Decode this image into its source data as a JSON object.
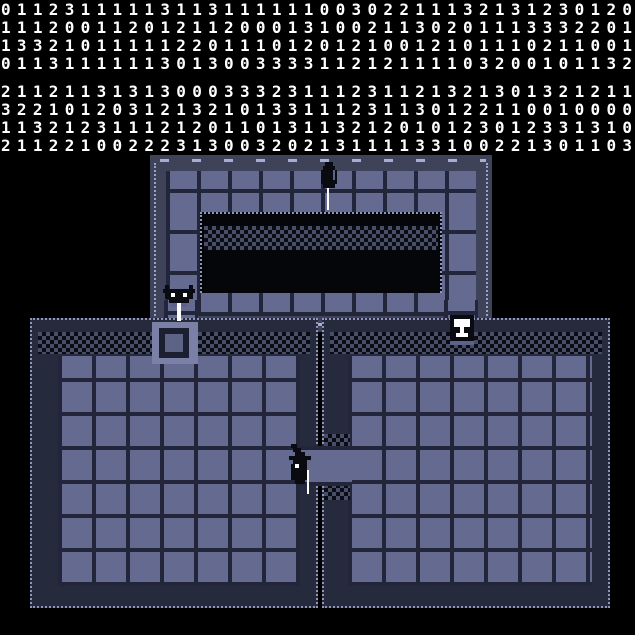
{
  "readout": {
    "description": "tile-code matrix, digits 0-3, two blocks of four rows",
    "digit_color": "#ffffff",
    "rows": [
      "0112311111311311111100302211132131230120",
      "1112001120121120001310021130201113332201",
      "1332101111122011101201210012101110211001",
      "0113111111301300333311212111103200101132",
      "2112113131300033323111231121321301321211",
      "3221012031213210133111231130122110010000",
      "1132123111212011013113212010123012331310",
      "2112210022231300320213111133100221301103"
    ]
  },
  "map": {
    "structure": {
      "top_loop": "ring corridor with dark inner chamber",
      "rooms": "two large tiled rooms joined by a gap passage",
      "links": "two one-tile corridors join the loop to the rooms"
    },
    "entities": [
      {
        "id": "hooded-figure",
        "label": "hooded figure with white staff, top corridor"
      },
      {
        "id": "bat-statue",
        "label": "bat statue over white sword, left junction"
      },
      {
        "id": "goblet-statue",
        "label": "white goblet idol, right junction"
      },
      {
        "id": "witch-figure",
        "label": "witch figure with white staff, center passage"
      },
      {
        "id": "pedestal-tile",
        "label": "square pedestal hatch tile"
      }
    ],
    "palette": {
      "background": "#000000",
      "floor_tile": "#656b90",
      "floor_gap": "#23263a",
      "wall_band": "#3e4359",
      "wall_dash": "#a7aed2",
      "checker_light": "#494e68",
      "checker_dark": "#0b0c13",
      "dotted_outline": "#8f96ba",
      "pedestal_plate": "#7b81a6",
      "sprite_dark": "#0a0b11",
      "sprite_accent": "#5c6288",
      "sprite_white": "#ffffff"
    }
  }
}
